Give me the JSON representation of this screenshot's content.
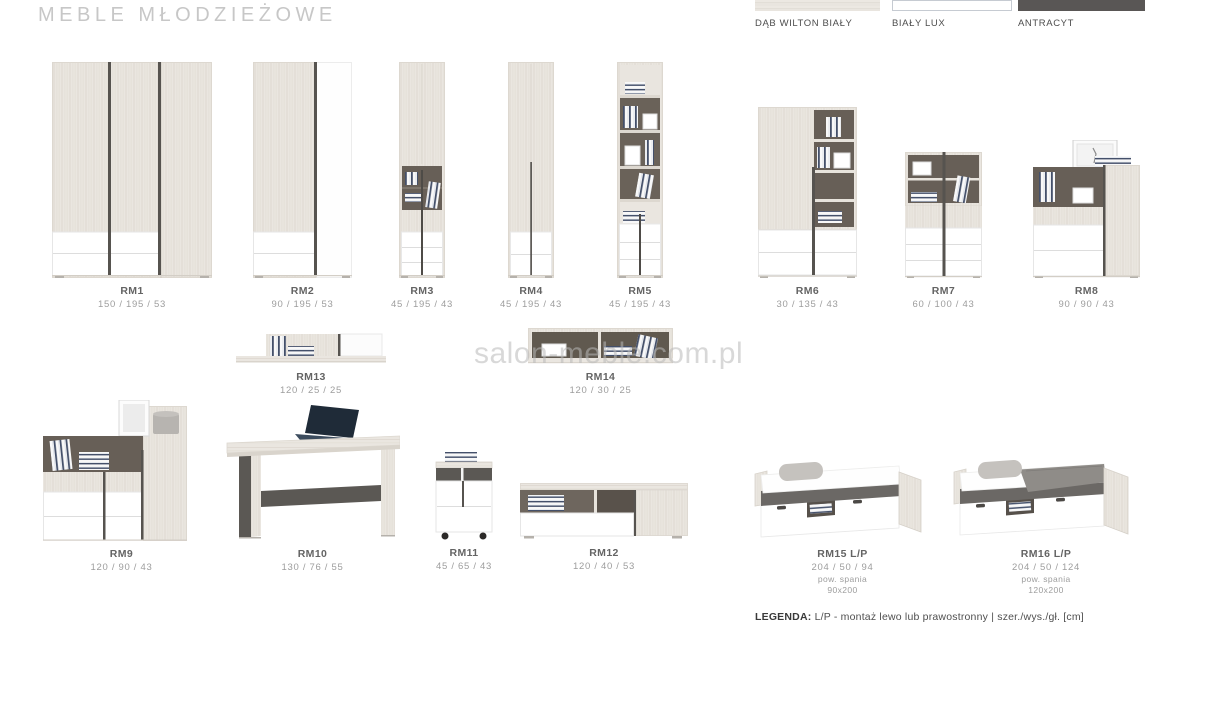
{
  "page": {
    "title": "MEBLE MŁODZIEŻOWE",
    "watermark": "salon-meble.com.pl",
    "legend_label": "LEGENDA:",
    "legend_text": "L/P - montaż lewo lub prawostronny | szer./wys./gł. [cm]"
  },
  "swatches": [
    {
      "name": "DĄB WILTON BIAŁY",
      "color": "#eae6e0"
    },
    {
      "name": "BIAŁY LUX",
      "color": "#ffffff"
    },
    {
      "name": "ANTRACYT",
      "color": "#595655"
    }
  ],
  "products": [
    {
      "code": "RM1",
      "dims": "150 / 195 / 53"
    },
    {
      "code": "RM2",
      "dims": "90 / 195 / 53"
    },
    {
      "code": "RM3",
      "dims": "45 / 195 / 43"
    },
    {
      "code": "RM4",
      "dims": "45 / 195 / 43"
    },
    {
      "code": "RM5",
      "dims": "45 / 195 / 43"
    },
    {
      "code": "RM6",
      "dims": "30 / 135 / 43"
    },
    {
      "code": "RM7",
      "dims": "60 / 100 / 43"
    },
    {
      "code": "RM8",
      "dims": "90 / 90 / 43"
    },
    {
      "code": "RM13",
      "dims": "120 / 25 / 25"
    },
    {
      "code": "RM14",
      "dims": "120 / 30 / 25"
    },
    {
      "code": "RM9",
      "dims": "120 / 90 / 43"
    },
    {
      "code": "RM10",
      "dims": "130 / 76 / 55"
    },
    {
      "code": "RM11",
      "dims": "45 / 65 / 43"
    },
    {
      "code": "RM12",
      "dims": "120 / 40 / 53"
    },
    {
      "code": "RM15 L/P",
      "dims": "204 / 50 / 94",
      "note_label": "pow. spania",
      "note_size": "90x200"
    },
    {
      "code": "RM16 L/P",
      "dims": "204 / 50 / 124",
      "note_label": "pow. spania",
      "note_size": "120x200"
    }
  ]
}
